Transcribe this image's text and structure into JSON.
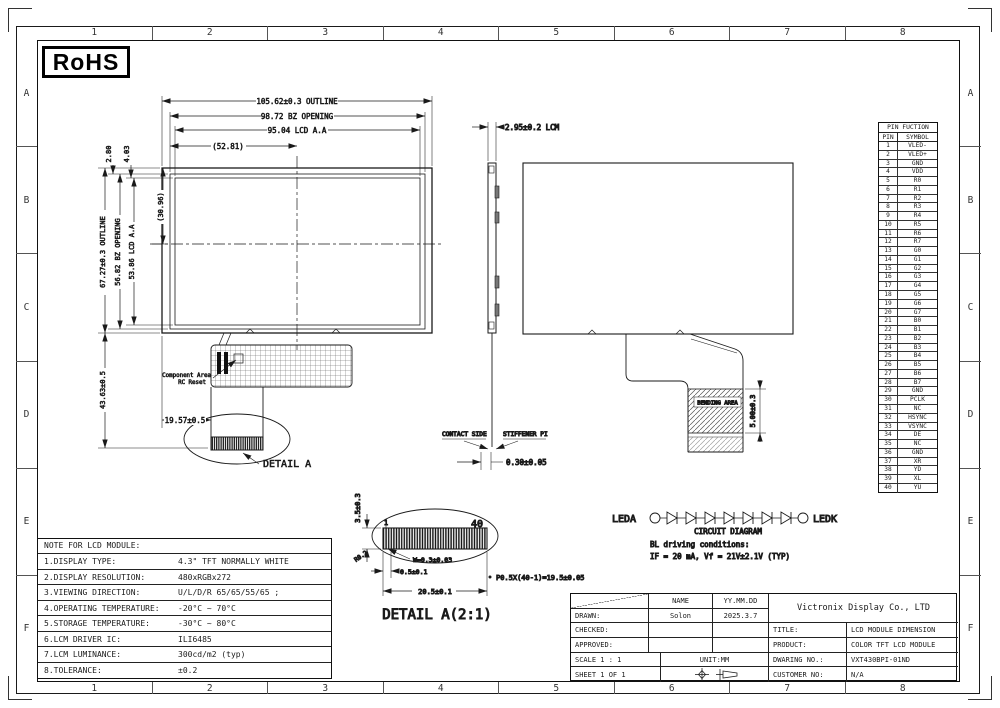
{
  "sheet": {
    "rohs": "RoHS",
    "grid_cols": [
      "1",
      "2",
      "3",
      "4",
      "5",
      "6",
      "7",
      "8"
    ],
    "grid_rows": [
      "A",
      "B",
      "C",
      "D",
      "E",
      "F"
    ]
  },
  "front_view": {
    "title_line1": "4.3\"TFT",
    "title_line2": "480*RGB*272",
    "title_line3": "View direction: 12o'clock",
    "dim_outline_w": "105.62±0.3 OUTLINE",
    "dim_bz_w": "98.72 BZ OPENING",
    "dim_aa_w": "95.04 LCD A.A",
    "dim_half_w": "(52.81)",
    "dim_outline_h": "67.27±0.3 OUTLINE",
    "dim_bz_h": "56.82 BZ OPENING",
    "dim_aa_h": "53.86 LCD A.A",
    "dim_center_h": "(30.96)",
    "dim_top_bezel": "2.80",
    "dim_top_aa": "4.03",
    "dim_tail_h": "43.63±0.5",
    "dim_tail_x": "19.57±0.5",
    "component_area": "Component Area",
    "rc_reset": "RC Reset",
    "detail_callout": "DETAIL A"
  },
  "side_view": {
    "dim_thickness": "2.95±0.2 LCM",
    "contact_side": "CONTACT SIDE",
    "stiffener": "STIFFENER PI",
    "dim_fpc_thickness": "0.30±0.05"
  },
  "back_view": {
    "bending_area": "BENDING AREA",
    "dim_bending": "5.00±0.3"
  },
  "detail_a": {
    "title": "DETAIL A(2:1)",
    "dim_height": "3.5±0.3",
    "radius": "R0.2",
    "dim_pin_width": "W=0.3±0.03",
    "dim_first_pitch": "0.5±0.1",
    "dim_total_width": "20.5±0.1",
    "dim_pitch_formula": "P0.5X(40-1)=19.5±0.05",
    "pin_first": "1",
    "pin_last": "40"
  },
  "circuit": {
    "anode": "LEDA",
    "cathode": "LEDK",
    "caption": "CIRCUIT DIAGRAM",
    "condition1": "BL driving conditions:",
    "condition2": "IF = 20 mA, Vf = 21V±2.1V (TYP)",
    "diode_count": 7
  },
  "notes": {
    "header": "NOTE FOR LCD MODULE:",
    "rows": [
      {
        "label": "1.DISPLAY TYPE:",
        "value": "4.3\" TFT NORMALLY WHITE"
      },
      {
        "label": "2.DISPLAY RESOLUTION:",
        "value": "480xRGBx272"
      },
      {
        "label": "3.VIEWING DIRECTION:",
        "value": "U/L/D/R  65/65/55/65 ;"
      },
      {
        "label": "4.OPERATING TEMPERATURE:",
        "value": "-20°C ~ 70°C"
      },
      {
        "label": "5.STORAGE TEMPERATURE:",
        "value": "-30°C ~ 80°C"
      },
      {
        "label": "6.LCM DRIVER IC:",
        "value": "ILI6485"
      },
      {
        "label": "7.LCM LUMINANCE:",
        "value": "300cd/m2 (typ)"
      },
      {
        "label": "8.TOLERANCE:",
        "value": "±0.2"
      }
    ]
  },
  "pin_table": {
    "title": "PIN FUCTION",
    "col_pin": "PIN",
    "col_symbol": "SYMBOL",
    "pins": [
      {
        "n": "1",
        "s": "VLED-"
      },
      {
        "n": "2",
        "s": "VLED+"
      },
      {
        "n": "3",
        "s": "GND"
      },
      {
        "n": "4",
        "s": "VDD"
      },
      {
        "n": "5",
        "s": "R0"
      },
      {
        "n": "6",
        "s": "R1"
      },
      {
        "n": "7",
        "s": "R2"
      },
      {
        "n": "8",
        "s": "R3"
      },
      {
        "n": "9",
        "s": "R4"
      },
      {
        "n": "10",
        "s": "R5"
      },
      {
        "n": "11",
        "s": "R6"
      },
      {
        "n": "12",
        "s": "R7"
      },
      {
        "n": "13",
        "s": "G0"
      },
      {
        "n": "14",
        "s": "G1"
      },
      {
        "n": "15",
        "s": "G2"
      },
      {
        "n": "16",
        "s": "G3"
      },
      {
        "n": "17",
        "s": "G4"
      },
      {
        "n": "18",
        "s": "G5"
      },
      {
        "n": "19",
        "s": "G6"
      },
      {
        "n": "20",
        "s": "G7"
      },
      {
        "n": "21",
        "s": "B0"
      },
      {
        "n": "22",
        "s": "B1"
      },
      {
        "n": "23",
        "s": "B2"
      },
      {
        "n": "24",
        "s": "B3"
      },
      {
        "n": "25",
        "s": "B4"
      },
      {
        "n": "26",
        "s": "B5"
      },
      {
        "n": "27",
        "s": "B6"
      },
      {
        "n": "28",
        "s": "B7"
      },
      {
        "n": "29",
        "s": "GND"
      },
      {
        "n": "30",
        "s": "PCLK"
      },
      {
        "n": "31",
        "s": "NC"
      },
      {
        "n": "32",
        "s": "HSYNC"
      },
      {
        "n": "33",
        "s": "VSYNC"
      },
      {
        "n": "34",
        "s": "DE"
      },
      {
        "n": "35",
        "s": "NC"
      },
      {
        "n": "36",
        "s": "GND"
      },
      {
        "n": "37",
        "s": "XR"
      },
      {
        "n": "38",
        "s": "YD"
      },
      {
        "n": "39",
        "s": "XL"
      },
      {
        "n": "40",
        "s": "YU"
      }
    ]
  },
  "title_block": {
    "name_header": "NAME",
    "date_header": "YY.MM.DD",
    "drawn_label": "DRAWN:",
    "drawn_name": "Solon",
    "drawn_date": "2025.3.7",
    "checked_label": "CHECKED:",
    "approved_label": "APPROVED:",
    "scale": "SCALE 1 : 1",
    "unit": "UNIT:MM",
    "sheet": "SHEET 1 OF 1",
    "company": "Victronix Display Co., LTD",
    "title_label": "TITLE:",
    "title_value": "LCD MODULE DIMENSION",
    "product_label": "PRODUCT:",
    "product_value": "COLOR TFT LCD MODULE",
    "drawing_no_label": "DWARING NO.:",
    "drawing_no_value": "VXT430BPI-01ND",
    "customer_no_label": "CUSTOMER NO:",
    "customer_no_value": "N/A"
  }
}
